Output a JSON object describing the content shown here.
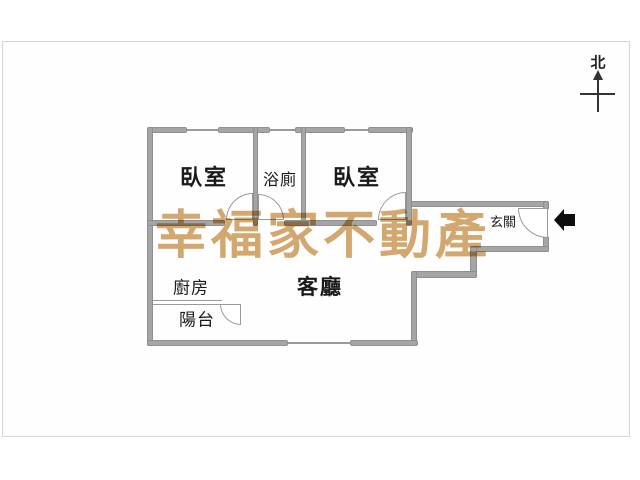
{
  "title": "apartment-floor-plan",
  "watermark": {
    "text": "幸福家不動產",
    "color": "#D0A060"
  },
  "compass": {
    "north_label": "北"
  },
  "rooms": {
    "bedroom_left": "臥室",
    "bathroom": "浴廁",
    "bedroom_right": "臥室",
    "entry": "玄關",
    "kitchen": "廚房",
    "living_room": "客廳",
    "balcony": "陽台"
  },
  "colors": {
    "wall_fill": "#A5A5A5",
    "wall_edge": "#8F8F8F",
    "line": "#9A9A9A",
    "text": "#1A1A1A",
    "watermark": "#D0A060",
    "entry_arrow": "#0D0D0D",
    "frame_border": "#D5D5D5"
  }
}
